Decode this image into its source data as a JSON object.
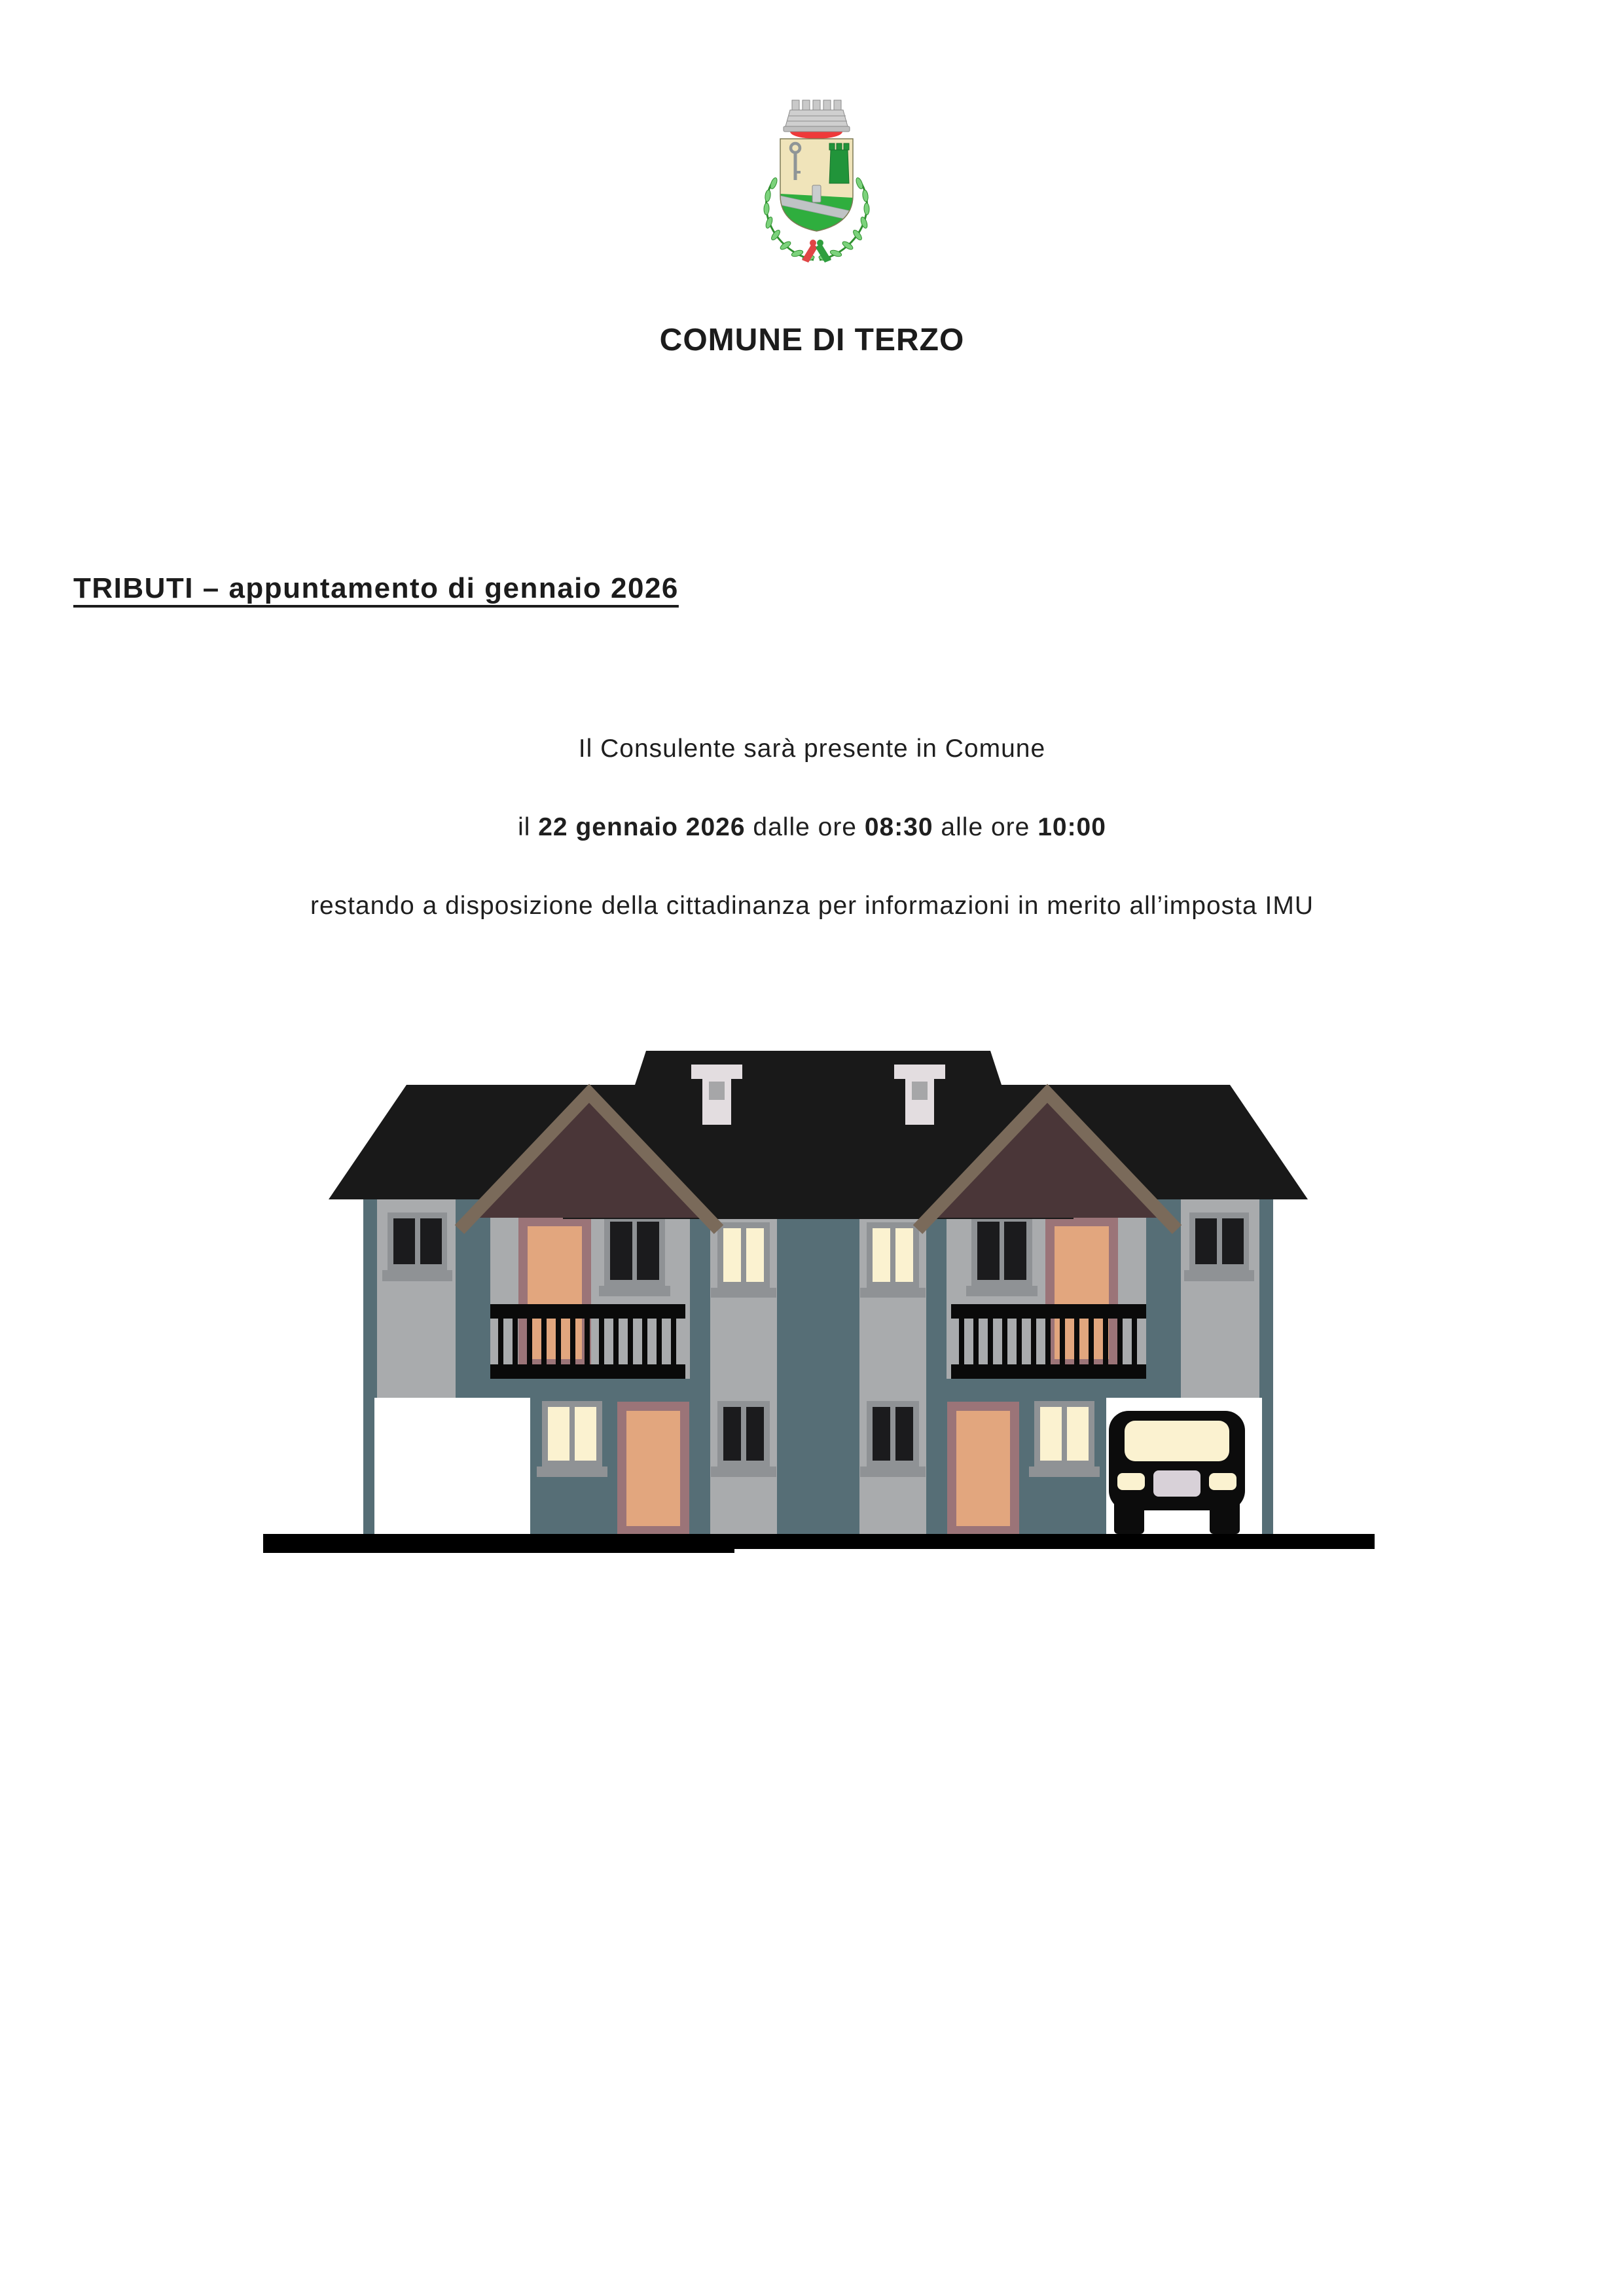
{
  "header": {
    "title": "COMUNE DI TERZO"
  },
  "notice": {
    "heading": "TRIBUTI – appuntamento di gennaio 2026",
    "line1": "Il Consulente sarà presente in Comune",
    "line2_parts": [
      "il ",
      "22 gennaio 2026",
      " dalle ore ",
      "08:30",
      " alle ore ",
      "10:00"
    ],
    "line3": "restando a disposizione della cittadinanza per informazioni in merito all’imposta IMU"
  },
  "crest": {
    "name": "coat-of-arms-comune-di-terzo",
    "colors": {
      "crown_silver": "#c9c9c9",
      "crown_band": "#cfcfcf",
      "crown_rim": "#c0c0c0",
      "crown_red": "#ee3a3a",
      "field_beige": "#f0e4ba",
      "field_green": "#2fae3e",
      "road_grey": "#bfc3c5",
      "milestone_grey": "#c9cdcf",
      "key_grey": "#8f9597",
      "tower_green": "#21943a",
      "laurel_leaf": "#7cd27c",
      "laurel_stem": "#2e8f2e",
      "ribbon_red": "#e04545",
      "ribbon_green": "#2f9e3e"
    }
  },
  "illustration": {
    "name": "twin-houses-evening",
    "colors": {
      "roof": "#191919",
      "wall_slate": "#566e76",
      "wall_grey": "#a9abad",
      "frame_grey": "#8f9295",
      "glass_dark": "#1b1b1d",
      "glass_lit": "#fbf2d0",
      "door_peach": "#e2a67e",
      "door_frame": "#9b7478",
      "gable_fill": "#4a3638",
      "gable_trim": "#7a6a5a",
      "chimney": "#e3dde0",
      "chimney_flue": "#a6a6a8",
      "balcony": "#0a0a0a",
      "garage_white": "#ffffff",
      "car_black": "#0c0c0c",
      "car_glass": "#fbf2d0",
      "car_plate": "#d8d1d8",
      "ground": "#000000"
    }
  }
}
